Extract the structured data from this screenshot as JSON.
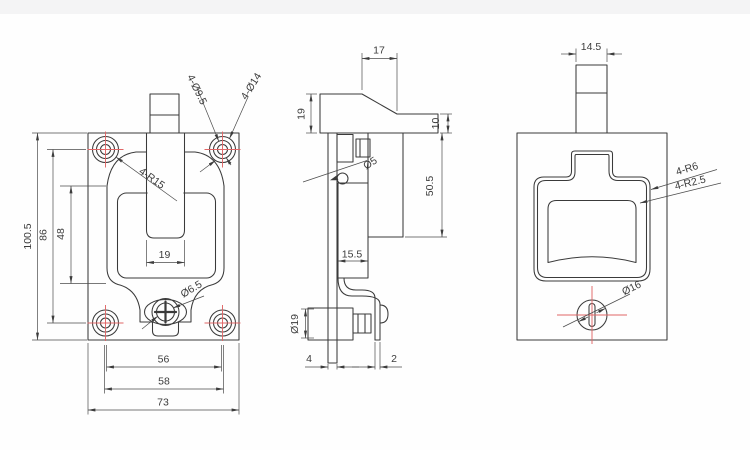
{
  "drawing": {
    "background": "#fefefe",
    "line_color": "#3a3a3a",
    "centerline_color": "#e06666",
    "views": {
      "front": {
        "dimensions": {
          "overall_height": "100.5",
          "hole_pitch_vertical": "86",
          "recess_height": "48",
          "slot_width": "19",
          "hole_pitch_horizontal": "56",
          "recess_width": "58",
          "overall_width": "73"
        },
        "callouts": {
          "corner_fillet": "4-R15",
          "mount_hole": "4-Ø9.5",
          "counterbore": "4-Ø14",
          "screw_hole": "Ø6.5"
        }
      },
      "side": {
        "dimensions": {
          "head_depth": "17",
          "head_height": "19",
          "head_step": "10",
          "body_depth": "50.5",
          "cam_width": "15.5",
          "plate_thickness": "4",
          "arm_thickness": "2"
        },
        "callouts": {
          "pin_hole": "Ø5",
          "pawl_diameter": "Ø19"
        }
      },
      "back": {
        "dimensions": {
          "tab_width": "14.5"
        },
        "callouts": {
          "recess_corner_radius": "4-R6",
          "inner_corner_radius": "4-R2.5",
          "cylinder_diameter": "Ø16"
        }
      }
    }
  }
}
